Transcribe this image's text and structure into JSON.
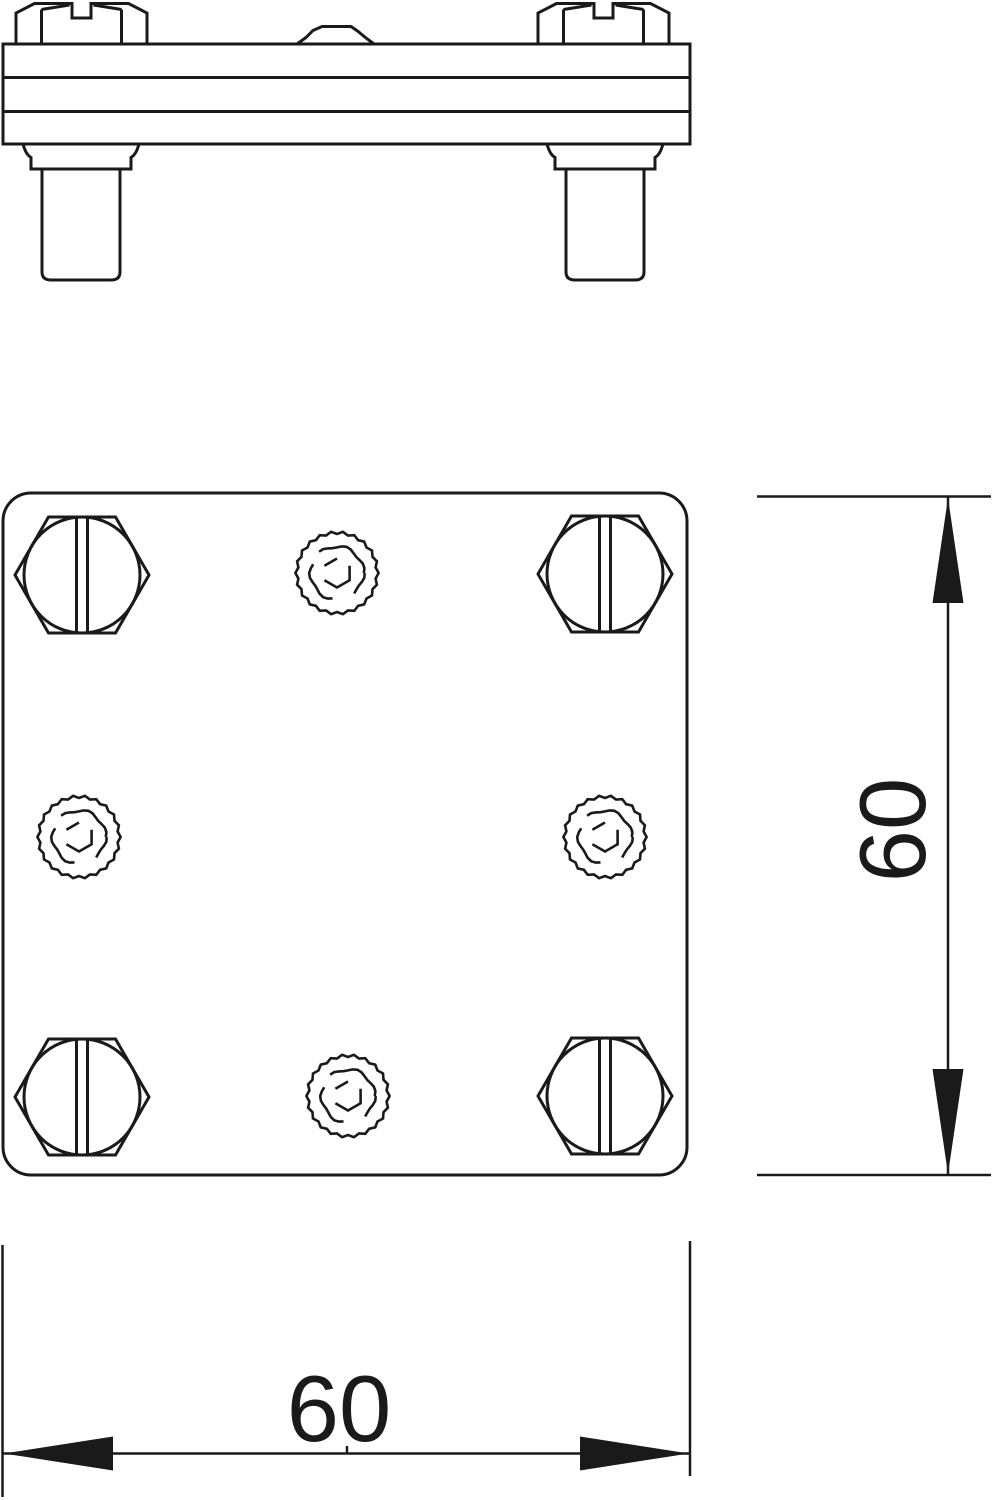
{
  "meta": {
    "background_color": "#ffffff",
    "line_color": "#1a1a1a",
    "drawing_type": "technical-drawing"
  },
  "dimensions": {
    "width_label": "60",
    "height_label": "60"
  },
  "features": {
    "hex_bolt_count": 4,
    "knurled_point_count": 4
  }
}
